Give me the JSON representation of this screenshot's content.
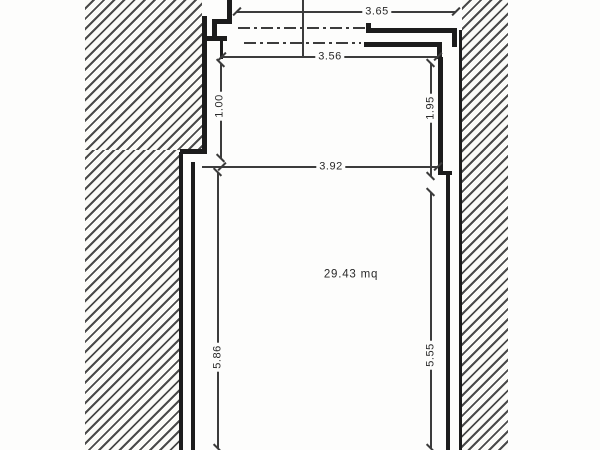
{
  "drawing": {
    "type": "floor-plan",
    "area_label": "29.43 mq",
    "dimensions": {
      "top_width": "3.65",
      "upper_width": "3.56",
      "upper_left_height": "1.00",
      "upper_right_height": "1.95",
      "main_width": "3.92",
      "main_left_height": "5.86",
      "main_right_height": "5.55"
    },
    "colors": {
      "paper": "#fdfdfc",
      "wall": "#1c1c1c",
      "dimension_line": "#3c3c3c",
      "hatch": "#4a4a4a"
    }
  }
}
